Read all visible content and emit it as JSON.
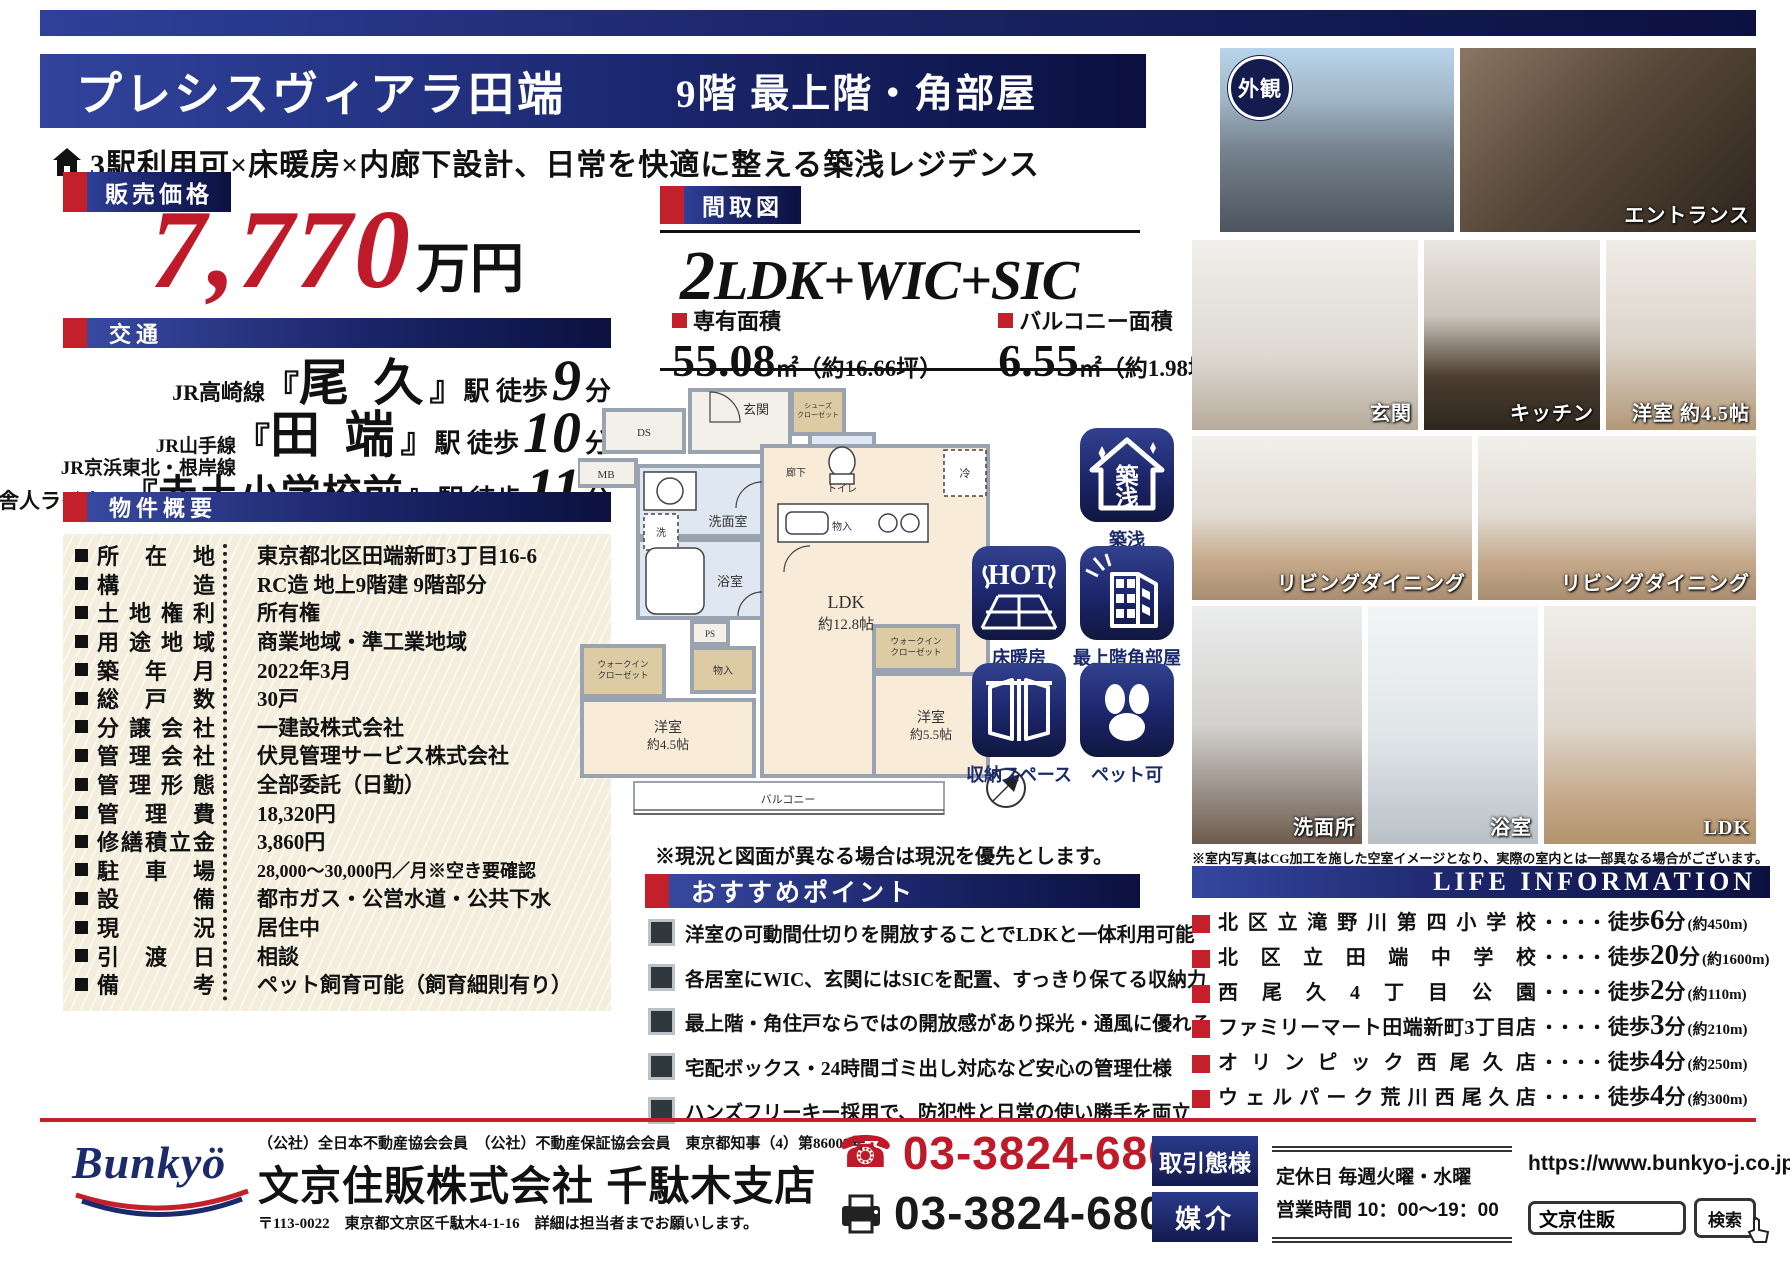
{
  "colors": {
    "navy": "#141b4e",
    "navy_light": "#2e4099",
    "red": "#c3202c",
    "price_red": "#bf1a2a",
    "table_cream": "#f4eedd"
  },
  "header": {
    "property_name": "プレシスヴィアラ田端",
    "floor_badge": "9階 最上階・角部屋",
    "catchphrase": "3駅利用可×床暖房×内廊下設計、日常を快適に整える築浅レジデンス"
  },
  "price": {
    "section_label": "販売価格",
    "amount": "7,770",
    "unit": "万円"
  },
  "access": {
    "section_label": "交通",
    "bracket_open": "『",
    "bracket_close": "』",
    "suffix": "駅 徒歩",
    "minute_unit": "分",
    "routes": [
      {
        "lines": [
          "JR高崎線"
        ],
        "station": "尾 久",
        "minutes": "9"
      },
      {
        "lines": [
          "JR山手線",
          "JR京浜東北・根岸線"
        ],
        "station": "田 端",
        "minutes": "10"
      },
      {
        "lines": [
          "日暮里・舎人ライナー"
        ],
        "station": "赤土小学校前",
        "minutes": "11"
      }
    ]
  },
  "overview": {
    "section_label": "物件概要",
    "rows": [
      {
        "label": "所在地",
        "value": "東京都北区田端新町3丁目16-6"
      },
      {
        "label": "構造",
        "value": "RC造 地上9階建 9階部分"
      },
      {
        "label": "土地権利",
        "value": "所有権"
      },
      {
        "label": "用途地域",
        "value": "商業地域・準工業地域"
      },
      {
        "label": "築年月",
        "value": "2022年3月"
      },
      {
        "label": "総戸数",
        "value": "30戸"
      },
      {
        "label": "分譲会社",
        "value": "一建設株式会社"
      },
      {
        "label": "管理会社",
        "value": "伏見管理サービス株式会社"
      },
      {
        "label": "管理形態",
        "value": "全部委託（日勤）"
      },
      {
        "label": "管理費",
        "value": "18,320円"
      },
      {
        "label": "修繕積立金",
        "value": "3,860円"
      },
      {
        "label": "駐車場",
        "value": "28,000～30,000円／月※空き要確認"
      },
      {
        "label": "設備",
        "value": "都市ガス・公営水道・公共下水"
      },
      {
        "label": "現況",
        "value": "居住中"
      },
      {
        "label": "引渡日",
        "value": "相談"
      },
      {
        "label": "備考",
        "value": "ペット飼育可能（飼育細則有り）"
      }
    ]
  },
  "floorplan": {
    "section_label": "間取図",
    "layout_prefix": "2",
    "layout_rest": "LDK+WIC+SIC",
    "area_label": "専有面積",
    "area_num": "55.08",
    "area_rest": "㎡（約16.66坪）",
    "balcony_label": "バルコニー面積",
    "balcony_num": "6.55",
    "balcony_rest": "㎡（約1.98坪）",
    "note": "※現況と図面が異なる場合は現況を優先とします。",
    "rooms": {
      "ds": "DS",
      "mb": "MB",
      "genkan": "玄関",
      "sic_a": "シューズ",
      "sic_b": "クローゼット",
      "toilet": "トイレ",
      "corridor": "廊下",
      "mono1": "物入",
      "senmen": "洗面室",
      "wash": "洗",
      "bath": "浴室",
      "ps": "PS",
      "wic1_a": "ウォークイン",
      "wic1_b": "クローゼット",
      "mono2": "物入",
      "rei": "冷",
      "west45_a": "洋室",
      "west45_b": "約4.5帖",
      "ldk_a": "LDK",
      "ldk_b": "約12.8帖",
      "wic2_a": "ウォークイン",
      "wic2_b": "クローゼット",
      "west55_a": "洋室",
      "west55_b": "約5.5帖",
      "balcony": "バルコニー"
    }
  },
  "badges": {
    "chiku_a": "築",
    "chiku_b": "浅",
    "hot": "HOT",
    "captions": [
      "築浅",
      "床暖房",
      "最上階角部屋",
      "収納スペース",
      "ペット可"
    ]
  },
  "points": {
    "section_label": "おすすめポイント",
    "items": [
      "洋室の可動間仕切りを開放することでLDKと一体利用可能",
      "各居室にWIC、玄関にはSICを配置、すっきり保てる収納力",
      "最上階・角住戸ならではの開放感があり採光・通風に優れる",
      "宅配ボックス・24時間ゴミ出し対応など安心の管理仕様",
      "ハンズフリーキー採用で、防犯性と日常の使い勝手を両立"
    ]
  },
  "photos": {
    "tag_exterior": "外観",
    "labels": [
      "エントランス",
      "玄関",
      "キッチン",
      "洋室 約4.5帖",
      "リビングダイニング",
      "リビングダイニング",
      "洗面所",
      "浴室",
      "LDK"
    ],
    "disclaimer": "※室内写真はCG加工を施した空室イメージとなり、実際の室内とは一部異なる場合がございます。"
  },
  "life": {
    "title": "LIFE  INFORMATION",
    "dots": "・・・・",
    "walk": "徒歩",
    "unit": "分",
    "rows": [
      {
        "name": "北区立滝野川第四小学校",
        "min": "6",
        "dist": "(約450m)"
      },
      {
        "name": "北区立田端中学校",
        "min": "20",
        "dist": "(約1600m)"
      },
      {
        "name": "西尾久4丁目公園",
        "min": "2",
        "dist": "(約110m)"
      },
      {
        "name": "ファミリーマート田端新町3丁目店",
        "min": "3",
        "dist": "(約210m)"
      },
      {
        "name": "オリンピック西尾久店",
        "min": "4",
        "dist": "(約250m)"
      },
      {
        "name": "ウェルパーク荒川西尾久店",
        "min": "4",
        "dist": "(約300m)"
      }
    ]
  },
  "footer": {
    "logo": "Bunkyö",
    "memberships": "（公社）全日本不動産協会会員　（公社）不動産保証協会会員　東京都知事（4）第86009号",
    "company": "文京住販株式会社 千駄木支店",
    "address": "〒113-0022　東京都文京区千駄木4-1-16　詳細は担当者までお願いします。",
    "tel": "03-3824-6800",
    "fax": "03-3824-6801",
    "deal_type_label": "取引態様",
    "deal_type_value": "媒介",
    "holiday": "定休日 毎週火曜・水曜",
    "hours": "営業時間 10：00～19：00",
    "url": "https://www.bunkyo-j.co.jp",
    "search_value": "文京住販",
    "search_button": "検索"
  }
}
